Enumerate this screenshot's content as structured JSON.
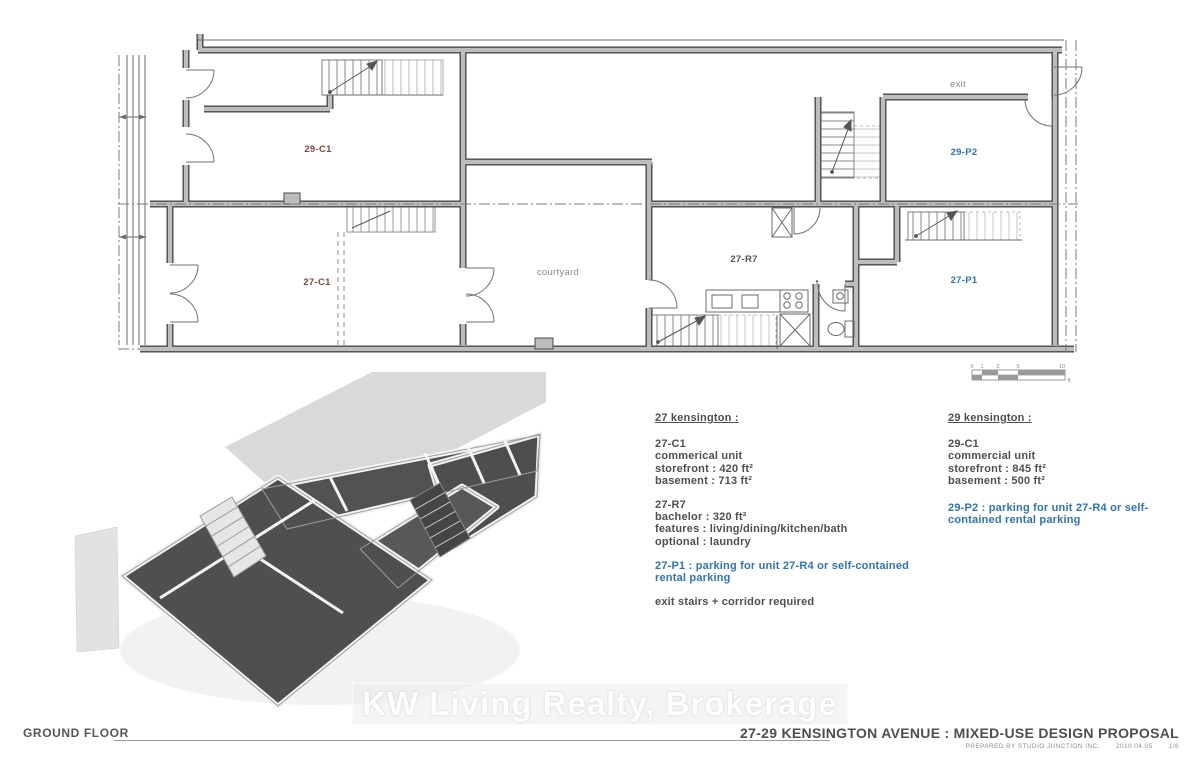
{
  "plan": {
    "labels": {
      "unit_29_c1": "29-C1",
      "unit_27_c1": "27-C1",
      "unit_27_r7": "27-R7",
      "unit_29_p2": "29-P2",
      "unit_27_p1": "27-P1",
      "courtyard": "courtyard",
      "exit": "exit"
    },
    "scale_bar": {
      "ticks": [
        "0",
        "1",
        "2",
        "5",
        "10"
      ],
      "unit": "ft"
    }
  },
  "notes_27": {
    "heading": "27 kensington :",
    "c1_title": "27-C1",
    "c1_lines": [
      "commerical unit",
      "storefront : 420 ft²",
      "basement : 713 ft²"
    ],
    "r7_title": "27-R7",
    "r7_lines": [
      "bachelor : 320 ft²",
      "features : living/dining/kitchen/bath",
      "optional : laundry"
    ],
    "p1_note": "27-P1 : parking for unit 27-R4 or self-contained rental parking",
    "exit_note": "exit stairs + corridor required"
  },
  "notes_29": {
    "heading": "29 kensington :",
    "c1_title": "29-C1",
    "c1_lines": [
      "commercial unit",
      "storefront : 845 ft²",
      "basement : 500 ft²"
    ],
    "p2_note": "29-P2 : parking for unit 27-R4 or self-contained rental parking"
  },
  "footer": {
    "floor_label": "GROUND FLOOR",
    "title": "27-29 KENSINGTON AVENUE : MIXED-USE DESIGN PROPOSAL",
    "prepared_by": "PREPARED BY STUDIO JUNCTION INC.",
    "date": "2010.04.05",
    "page_number": "1/6"
  },
  "watermark": {
    "text": "KW Living Realty, Brokerage"
  },
  "colors": {
    "commercial_label": "#7e4a3e",
    "parking_label": "#2e74b5",
    "note_text": "#4f4f4f",
    "wall_gray": "#b8b8b8",
    "wall_edge": "#4a4a4a"
  }
}
